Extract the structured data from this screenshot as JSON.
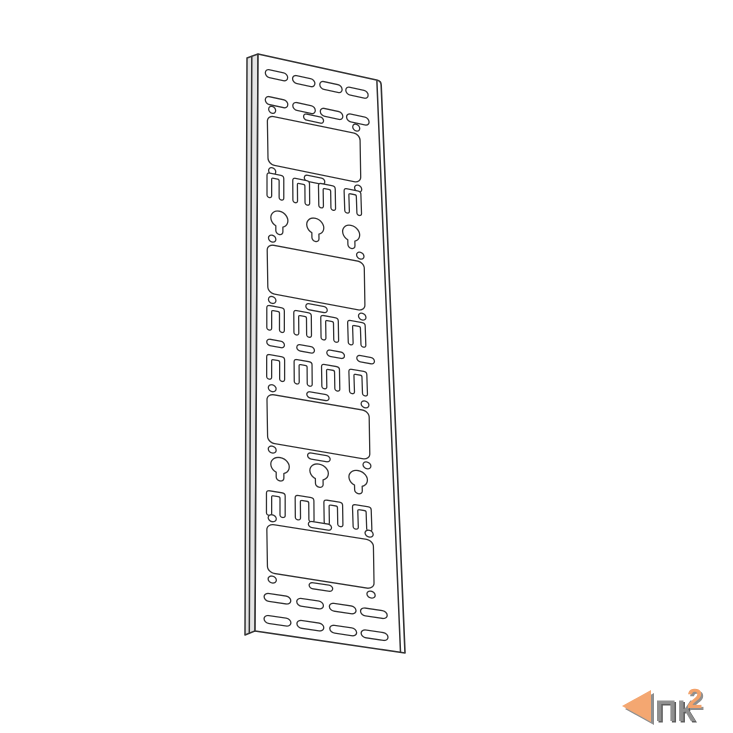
{
  "page": {
    "background": "#ffffff"
  },
  "logo": {
    "text": "ПК",
    "sup": "2",
    "triangle_color": "#f4a771",
    "triangle_shadow_color": "#8f8f8f",
    "text_color": "#8f8f8f",
    "text_shadow_color": "#5d5d5d",
    "sup_color": "#f2a26b",
    "sup_shadow_color": "#8f8f8f"
  },
  "drawing": {
    "description": "vertical-cable-organizer-panel",
    "stroke": "#333333",
    "face_fill": "#ffffff",
    "flange_fill": "#e4e4e4",
    "quad": {
      "tl": [
        258,
        54
      ],
      "tr": [
        381,
        81
      ],
      "br": [
        405,
        653
      ],
      "bl": [
        255,
        631
      ]
    },
    "flange": {
      "outer_top": [
        247,
        58
      ],
      "outer_bottom": [
        245,
        635
      ],
      "crease_top": [
        251.8,
        56.3
      ],
      "crease_bottom": [
        249.3,
        633.4
      ]
    },
    "right_fold": {
      "top": [
        376.9,
        81.3
      ],
      "bottom": [
        400.5,
        652.3
      ]
    },
    "grid": {
      "u_max": 100,
      "v_max": 470
    },
    "shapes": {
      "slot": {
        "centers": [
          15,
          37,
          59,
          80
        ],
        "w": 18,
        "h": 6.4
      },
      "slot_small": {
        "centers": [
          14,
          36,
          58,
          80
        ],
        "w": 13,
        "h": 5.2
      },
      "tslot": {
        "centers": [
          14,
          34,
          54,
          74
        ],
        "hw": 6.5,
        "hh": 10,
        "t": 3.6,
        "r": 2.2
      },
      "keyhole": {
        "centers": [
          17,
          44.5,
          72
        ],
        "r": 6.5,
        "neck_hw": 2.7,
        "neck_len": 12.5
      },
      "holes": {
        "circle_u": [
          11.5,
          78.5
        ],
        "circle_r": 2.8,
        "oblong_u": 44.5,
        "oblong_w": 16,
        "oblong_h": 5
      },
      "window": {
        "u0": 8,
        "u1": 81,
        "h": 40,
        "r": 5,
        "holes_offset": 25
      }
    },
    "rows": [
      {
        "t": "slots",
        "v": 14
      },
      {
        "t": "slots",
        "v": 36
      },
      {
        "t": "window",
        "v": 68,
        "top_oblong": true
      },
      {
        "t": "tslots",
        "v": 105
      },
      {
        "t": "keyholes",
        "v": 131
      },
      {
        "t": "window",
        "v": 173,
        "top_oblong": false
      },
      {
        "t": "tslots",
        "v": 213
      },
      {
        "t": "slots_small",
        "v": 233
      },
      {
        "t": "tslots",
        "v": 253
      },
      {
        "t": "window",
        "v": 295,
        "top_oblong": true
      },
      {
        "t": "keyholes",
        "v": 332
      },
      {
        "t": "tslots",
        "v": 364
      },
      {
        "t": "window",
        "v": 401,
        "top_oblong": true
      },
      {
        "t": "slots",
        "v": 441
      },
      {
        "t": "slots",
        "v": 459
      }
    ]
  }
}
